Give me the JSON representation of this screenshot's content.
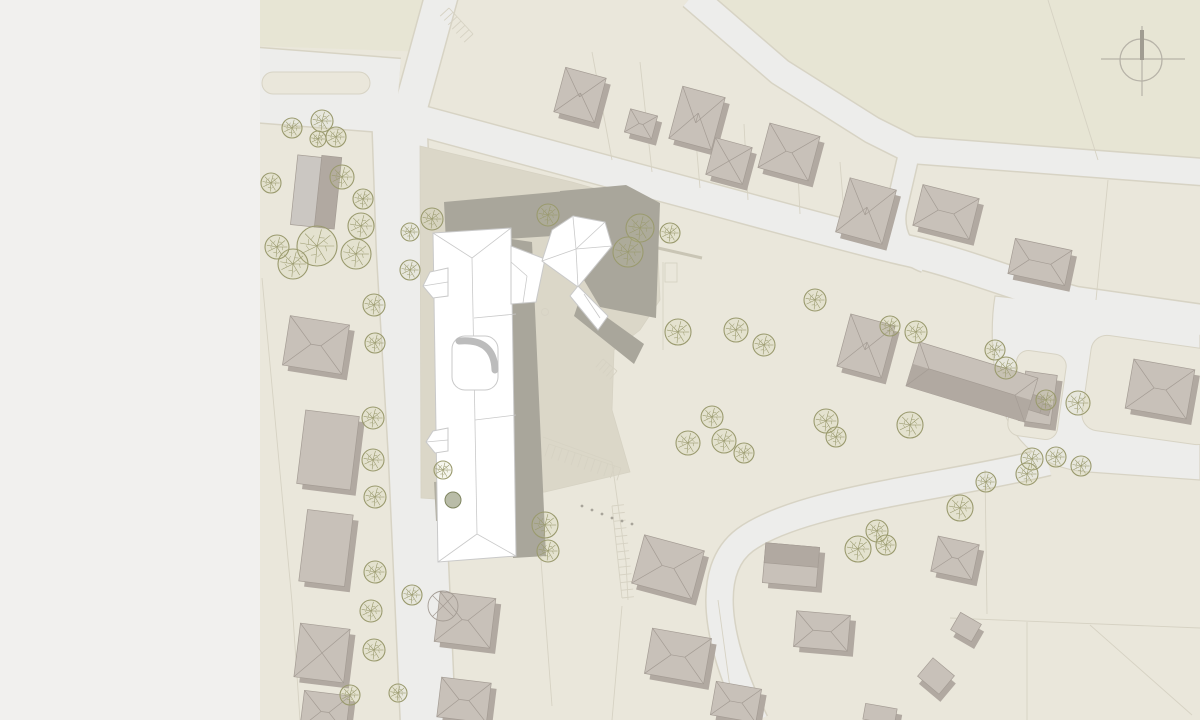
{
  "meta": {
    "view_label": "site-plan",
    "north_indicator": "north-arrow"
  },
  "colors": {
    "sidebar": "#f1f0ee",
    "parcel": "#eae7db",
    "field": "#e7e5d4",
    "road": "#ededeb",
    "road_edge": "#d7d3c4",
    "plaza": "#dbd7c8",
    "shadow": "#a9a69b",
    "bldg_fill": "#c8c1b9",
    "bldg_side": "#b1a9a1",
    "bldg_line": "#a49c94",
    "white": "#ffffff",
    "white_line": "#c9c9c9",
    "court_shadow": "#bcbcbc",
    "tree": "#9a9a6e",
    "tree_fill": "#c8c896",
    "parcel_line": "#d6d2c3",
    "arrow": "#b7b3a8",
    "arrow_dark": "#a09c91",
    "yard": "#b2afa2",
    "dark_tree": "#7f8560"
  },
  "map": {
    "fields": [
      {
        "d": "M692,-4 L780,70 L872,128 L912,148 L1200,170 L1200,-4 Z"
      },
      {
        "d": "M258,-2 L434,-2 L427,52 L258,46 Z"
      }
    ],
    "roads": [
      {
        "d": "M256,85 L398,96",
        "w": 74
      },
      {
        "d": "M399,106 L404,250 L416,455 L428,722",
        "w": 54
      },
      {
        "d": "M442,-6 L424,60 L408,118",
        "w": 32
      },
      {
        "d": "M410,118 L640,180 C760,212 860,240 905,250 C960,262 1030,290 1075,302 L1202,320",
        "w": 30
      },
      {
        "d": "M692,-4 L780,72 L872,130 L912,150 L1202,172",
        "w": 26
      },
      {
        "d": "M908,158 L896,210 C892,235 905,255 925,262",
        "w": 20
      },
      {
        "d": "M1048,462 C940,488 800,500 745,540 C705,570 715,640 755,722",
        "w": 26
      }
    ],
    "road_areas": [
      {
        "d": "M995,296 L1200,318 L1200,480 L1088,472 C1032,468 1008,432 999,396 C992,362 990,326 995,296 Z"
      }
    ],
    "islands": [
      {
        "x": 262,
        "y": 72,
        "w": 108,
        "h": 22,
        "rx": 11,
        "rot": 0,
        "cx": 0,
        "cy": 0
      },
      {
        "x": -25,
        "y": -43,
        "w": 50,
        "h": 86,
        "rx": 12,
        "rot": 8,
        "cx": 1037,
        "cy": 395
      },
      {
        "x": -66,
        "y": -48,
        "w": 132,
        "h": 96,
        "rx": 16,
        "rot": 8,
        "cx": 1152,
        "cy": 390
      }
    ],
    "site_plaza": {
      "d": "M420,146 L572,182 L656,206 L660,300 L640,330 L614,350 L612,410 L630,472 L545,492 L450,500 L421,498 Z"
    },
    "parcel_lines": [
      [
        612,
        160,
        592,
        52
      ],
      [
        652,
        172,
        640,
        62
      ],
      [
        700,
        188,
        692,
        94
      ],
      [
        748,
        200,
        744,
        124
      ],
      [
        800,
        214,
        796,
        132
      ],
      [
        845,
        226,
        840,
        162
      ],
      [
        1048,
        0,
        1098,
        160
      ],
      [
        1108,
        180,
        1096,
        300
      ],
      [
        985,
        470,
        987,
        614
      ],
      [
        950,
        618,
        1200,
        628
      ],
      [
        1027,
        622,
        1027,
        720
      ],
      [
        1090,
        625,
        1192,
        715
      ],
      [
        536,
        494,
        552,
        706
      ],
      [
        622,
        606,
        612,
        720
      ],
      [
        718,
        600,
        730,
        688
      ],
      [
        262,
        278,
        292,
        602
      ],
      [
        292,
        602,
        300,
        720
      ],
      [
        663,
        262,
        663,
        350
      ],
      [
        543,
        437,
        612,
        462
      ],
      [
        612,
        462,
        626,
        562
      ],
      [
        626,
        562,
        628,
        600
      ]
    ],
    "curbs": [
      [
        658,
        248,
        702,
        258
      ]
    ],
    "small_rects": [
      [
        665,
        263,
        12,
        19
      ]
    ],
    "small_circles": [
      [
        545,
        312,
        3.5
      ]
    ],
    "stall_rows": [
      {
        "x1": 549,
        "y1": 444,
        "x2": 621,
        "y2": 468,
        "len": 13,
        "n": 11
      },
      {
        "x1": 612,
        "y1": 506,
        "x2": 622,
        "y2": 598,
        "len": -12,
        "n": 12
      },
      {
        "x1": 449,
        "y1": 8,
        "x2": 473,
        "y2": 34,
        "len": 12,
        "n": 6
      },
      {
        "x1": 603,
        "y1": 359,
        "x2": 617,
        "y2": 371,
        "len": 11,
        "n": 4
      }
    ],
    "dots": [
      [
        582,
        506
      ],
      [
        592,
        510
      ],
      [
        602,
        514
      ],
      [
        612,
        518
      ],
      [
        622,
        521
      ],
      [
        632,
        524
      ]
    ],
    "shadows": [
      {
        "d": "M444,202 L566,191 L568,235 L446,243 Z"
      },
      {
        "d": "M560,191 L626,185 L660,203 L656,318 L600,307 L562,243 Z"
      },
      {
        "d": "M505,238 L532,242 L546,556 L513,558 Z"
      },
      {
        "d": "M580,298 L644,344 L634,364 L574,316 Z"
      }
    ],
    "houses": [
      [
        580,
        95,
        42,
        46,
        15,
        "hip"
      ],
      [
        641,
        124,
        28,
        24,
        15,
        "hip"
      ],
      [
        697,
        118,
        44,
        54,
        15,
        "hip"
      ],
      [
        729,
        161,
        38,
        38,
        15,
        "pyramid"
      ],
      [
        789,
        152,
        52,
        46,
        15,
        "hip"
      ],
      [
        866,
        211,
        48,
        56,
        15,
        "hip"
      ],
      [
        946,
        212,
        58,
        42,
        14,
        "hip"
      ],
      [
        1040,
        262,
        58,
        36,
        12,
        "hip"
      ],
      [
        866,
        346,
        46,
        54,
        15,
        "hip"
      ],
      [
        1160,
        389,
        62,
        50,
        10,
        "hip"
      ],
      [
        1038,
        398,
        32,
        50,
        8,
        "flat"
      ],
      [
        316,
        345,
        60,
        50,
        9,
        "hip"
      ],
      [
        328,
        450,
        54,
        74,
        7,
        "flat"
      ],
      [
        326,
        548,
        46,
        72,
        7,
        "flat"
      ],
      [
        322,
        653,
        50,
        54,
        7,
        "pyramid"
      ],
      [
        325,
        712,
        46,
        38,
        7,
        "hip"
      ],
      [
        465,
        620,
        56,
        50,
        7,
        "hip"
      ],
      [
        464,
        700,
        50,
        40,
        7,
        "hip"
      ],
      [
        668,
        567,
        62,
        50,
        15,
        "hip"
      ],
      [
        678,
        656,
        60,
        46,
        10,
        "hip"
      ],
      [
        736,
        702,
        46,
        34,
        10,
        "hip"
      ],
      [
        791,
        565,
        54,
        40,
        5,
        "gable2"
      ],
      [
        822,
        631,
        54,
        36,
        5,
        "hip"
      ],
      [
        955,
        558,
        42,
        36,
        12,
        "hip"
      ],
      [
        966,
        627,
        24,
        20,
        30,
        "flat"
      ],
      [
        936,
        676,
        28,
        24,
        40,
        "flat"
      ],
      [
        880,
        714,
        32,
        16,
        10,
        "flat"
      ]
    ],
    "tall_block": {
      "cx": 316,
      "cy": 192,
      "rot": 6,
      "front": [
        -22,
        -35,
        24,
        70
      ],
      "side": [
        2,
        -37,
        20,
        72
      ]
    },
    "long_building": {
      "cx": 972,
      "cy": 382,
      "rot": 17,
      "w": 124,
      "h": 46,
      "ridge": 45,
      "steps": [
        [
          62,
          -6,
          12,
          16
        ],
        [
          74,
          -1,
          9,
          11
        ]
      ]
    },
    "main_building": {
      "yard": "M434,482 L470,479 L472,518 L436,521 Z",
      "wing": "M433,233 L511,228 L516,556 L438,562 Z",
      "ridge": "M472,258 L477,534",
      "hips": [
        "M433,233 L472,258",
        "M511,228 L472,258",
        "M438,562 L477,534",
        "M516,556 L477,534",
        "M474,318 L516,314",
        "M475,420 L516,415"
      ],
      "porch1": "M448,268 L430,272 L423,286 L433,298 L448,296 Z",
      "porch1_line": "M423,286 L448,282",
      "porch2": "M448,428 L433,431 L426,442 L435,453 L448,451 Z",
      "porch2_line": "M426,442 L448,440",
      "annex": "M511,246 L545,259 L536,302 L511,304 Z",
      "annex_lines": [
        "M511,262 L527,276",
        "M527,276 L523,303"
      ],
      "b2": "M573,216 L605,222 L612,246 L578,287 L542,261 L552,230 Z",
      "b2_ridges": [
        "M576,249 L573,217",
        "M576,249 L605,222",
        "M576,249 L612,246",
        "M576,249 L542,261",
        "M576,249 L578,287"
      ],
      "b2_wing": "M578,286 L608,316 L598,330 L570,296 Z",
      "b2_wing_line": "M584,294 L600,318",
      "court": {
        "x": 452,
        "y": 336,
        "w": 46,
        "h": 54,
        "rx": 13
      },
      "court_shadow": "M459,341 Q494,338 495,370",
      "dark_tree": [
        453,
        500,
        8
      ]
    },
    "trees": [
      [
        292,
        128,
        10
      ],
      [
        322,
        121,
        11
      ],
      [
        318,
        139,
        8
      ],
      [
        336,
        137,
        10
      ],
      [
        342,
        177,
        12
      ],
      [
        363,
        199,
        10
      ],
      [
        361,
        226,
        13
      ],
      [
        356,
        254,
        15
      ],
      [
        317,
        246,
        20
      ],
      [
        293,
        264,
        15
      ],
      [
        271,
        183,
        10
      ],
      [
        277,
        247,
        12
      ],
      [
        374,
        305,
        11
      ],
      [
        375,
        343,
        10
      ],
      [
        373,
        418,
        11
      ],
      [
        373,
        460,
        11
      ],
      [
        375,
        497,
        11
      ],
      [
        375,
        572,
        11
      ],
      [
        371,
        611,
        11
      ],
      [
        374,
        650,
        11
      ],
      [
        412,
        595,
        10
      ],
      [
        350,
        695,
        10
      ],
      [
        398,
        693,
        9
      ],
      [
        432,
        219,
        11
      ],
      [
        410,
        232,
        9
      ],
      [
        410,
        270,
        10
      ],
      [
        548,
        215,
        11
      ],
      [
        640,
        228,
        14
      ],
      [
        670,
        233,
        10
      ],
      [
        628,
        252,
        15
      ],
      [
        678,
        332,
        13
      ],
      [
        736,
        330,
        12
      ],
      [
        764,
        345,
        11
      ],
      [
        712,
        417,
        11
      ],
      [
        688,
        443,
        12
      ],
      [
        724,
        441,
        12
      ],
      [
        744,
        453,
        10
      ],
      [
        826,
        421,
        12
      ],
      [
        836,
        437,
        10
      ],
      [
        815,
        300,
        11
      ],
      [
        545,
        525,
        13
      ],
      [
        548,
        551,
        11
      ],
      [
        443,
        470,
        9
      ],
      [
        858,
        549,
        13
      ],
      [
        877,
        531,
        11
      ],
      [
        886,
        545,
        10
      ],
      [
        890,
        326,
        10
      ],
      [
        916,
        332,
        11
      ],
      [
        995,
        350,
        10
      ],
      [
        1006,
        368,
        11
      ],
      [
        1046,
        400,
        10
      ],
      [
        910,
        425,
        13
      ],
      [
        1032,
        459,
        11
      ],
      [
        1056,
        457,
        10
      ],
      [
        1027,
        474,
        11
      ],
      [
        960,
        508,
        13
      ],
      [
        986,
        482,
        10
      ],
      [
        1081,
        466,
        10
      ],
      [
        1078,
        403,
        12
      ]
    ],
    "bushes": [
      [
        443,
        606,
        15
      ]
    ],
    "north_arrow": {
      "cx": 1141,
      "cy": 60,
      "r": 21,
      "h1": 1101,
      "h2": 1185,
      "v1": 26,
      "v2": 96,
      "bar_top": 30
    }
  }
}
